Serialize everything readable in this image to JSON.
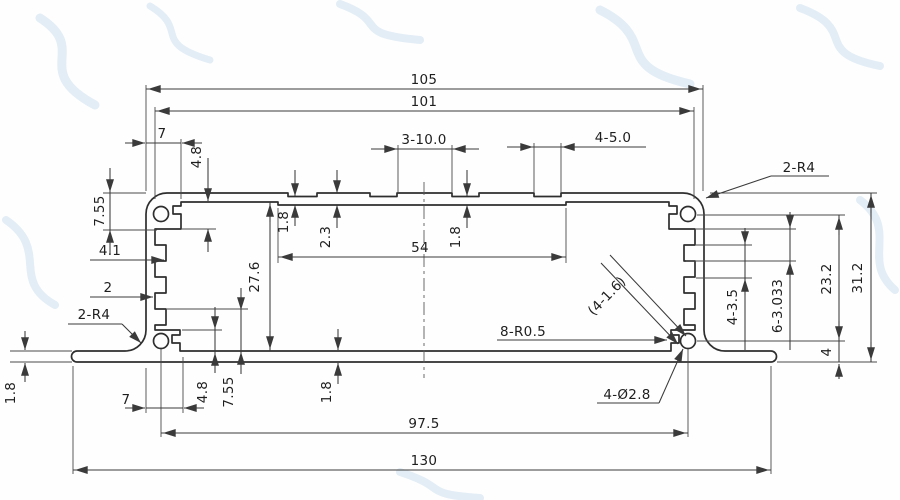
{
  "drawing": {
    "kind": "extrusion-profile-cross-section",
    "units": "mm",
    "line_color": "#2e2e2e",
    "watermark_color": "#d9e7f3",
    "dims": {
      "overall_width": "105",
      "inner_width": "101",
      "ledge_width_top": "7",
      "pad_width": "3-10.0",
      "slot_width": "4-5.0",
      "corner_radius_top": "2-R4",
      "corner_radius_bottom": "2-R4",
      "boss_depth_top": "7.55",
      "ledge_step_top": "4.8",
      "roof_thk_recess_left": "1.8",
      "roof_thk_mid": "2.3",
      "roof_thk_recess_mid": "1.8",
      "ceiling_span": "54",
      "groove_depth": "4.1",
      "wall_thk": "2",
      "inner_height": "27.6",
      "slot_note": "(4-1.6)",
      "fillet_note": "8-R0.5",
      "screw_holes": "4-Ø2.8",
      "boss_offset": "4-3.5",
      "serration_pitch": "6-3.033",
      "hole_span_v": "23.2",
      "overall_height": "31.2",
      "hole_to_base": "4",
      "flange_thk": "1.8",
      "ledge_width_bottom": "7",
      "ledge_step_bottom": "4.8",
      "boss_depth_bottom": "7.55",
      "base_thk": "1.8",
      "hole_span_h": "97.5",
      "overall_width_flange": "130"
    }
  }
}
